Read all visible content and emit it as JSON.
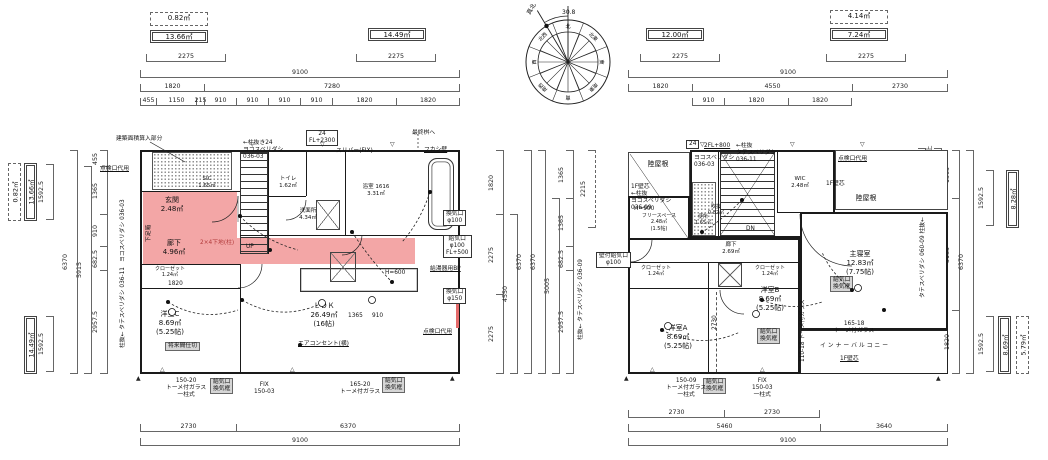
{
  "sheet": {
    "bg": "#ffffff",
    "line": "#1a1a1a",
    "dim": "#666666",
    "pink": "#f3a6a6",
    "gray": "#d6d6d6",
    "red": "#b23b3b"
  },
  "top_boxes": {
    "tl_dashed": "0.82㎡",
    "tl_double": "13.66㎡",
    "tm_double": "14.49㎡",
    "tr_double": "12.00㎡",
    "trr_dashed": "4.14㎡",
    "trr_double": "7.24㎡"
  },
  "side_boxes": {
    "left_top_dashed": "0.82㎡",
    "left_top_double": "13.66㎡",
    "left_bottom_double": "14.49㎡",
    "right_top_double": "8.28㎡",
    "right_bottom_double": "8.69㎡",
    "right_bottom_dashed": "5.79㎡"
  },
  "compass": {
    "dirs": [
      "北",
      "北東",
      "東",
      "南東",
      "南",
      "南西",
      "西",
      "北西"
    ],
    "north_label": "真北",
    "north_angle": "30.8"
  },
  "plan1": {
    "dims": {
      "d2275_left": "2275",
      "d2275_mid": "2275",
      "top_total": "9100",
      "row2": [
        "1820",
        "7280"
      ],
      "row3": [
        "455",
        "1150",
        "215",
        "910",
        "910",
        "910",
        "910",
        "1820",
        "1820"
      ],
      "bottom_row": [
        "2730",
        "6370"
      ],
      "bottom_total": "9100",
      "left_inner": [
        "455",
        "1365",
        "910",
        "682.5",
        "2957.5"
      ],
      "left_mid": "5915",
      "left_outer": "6370",
      "right_inner": [
        "1820",
        "2275",
        "2275"
      ],
      "right_mid": "4550",
      "right_outer": "6370",
      "sidebox_dim": "1592.5",
      "inner_1820": "1820",
      "inner_1365": "1365",
      "inner_910": "910"
    },
    "rooms": {
      "genkan": {
        "name": "玄関",
        "area": "2.48㎡"
      },
      "sic": {
        "name": "SIC",
        "area": "1.65㎡"
      },
      "rouka": {
        "name": "廊下",
        "area": "4.96㎡"
      },
      "toilet": {
        "name": "トイレ",
        "area": "1.62㎡"
      },
      "senmen": {
        "name": "洗面所",
        "area": "4.34㎡"
      },
      "bath": {
        "name": "浴室 1616",
        "area": "3.31㎡"
      },
      "ldk": {
        "name": "ＬＤＫ",
        "area": "26.49㎡",
        "tatami": "(16帖)"
      },
      "yoshitsu_c": {
        "name": "洋室C",
        "area": "8.69㎡",
        "tatami": "(5.25帖)"
      },
      "closet": {
        "name": "クローゼット",
        "area": "1.24㎡"
      },
      "shoebox": "下足箱",
      "up": "UP"
    },
    "notes": {
      "kenchiku": "建築面積算入部分",
      "tenken_top": "点検口代用",
      "win24": "24\nFL+2300",
      "hashira24": "←柱抜き24\nヨコスベリダシ\n036-03",
      "slit": "スリバー(FIX)",
      "masu": "最終桝へ",
      "fukashi": "フカシ壁",
      "kanki100": "換気口\nφ100",
      "kyuki100": "給気口\nφ100\nFL+500",
      "kyutoki": "給湯器用BP",
      "kanki150": "換気口\nφ150",
      "tenken_right": "点検口代用",
      "aircon": "エアコンセント(横)",
      "shitaji": "2×4下地(柱)",
      "majikiri": "将来間仕切",
      "w15020": "150-20\nトーメ付ガラス\n一柱式",
      "kyukikamachi": "給気口\n換気框",
      "fix15003": "FIX\n150-03",
      "w16520": "165-20\nトーメ付ガラス",
      "h600": "H=600",
      "win_left_top": "ヨコスベリダシ 036-03",
      "win_left_bottom": "柱抜← タテスベリダシ 036-11"
    }
  },
  "plan2": {
    "dims": {
      "d2275_left": "2275",
      "d2275_right": "2275",
      "top_total": "9100",
      "row2": [
        "1820",
        "4550",
        "2730"
      ],
      "row3": [
        "910",
        "1820",
        "1820"
      ],
      "bottom_row1": [
        "2730",
        "2730"
      ],
      "bottom_row2": [
        "5460",
        "3640"
      ],
      "bottom_total": "9100",
      "left_inner": [
        "1365",
        "1365",
        "682.5",
        "2957.5"
      ],
      "left_mid": "5005",
      "left_outer": "6370",
      "left_dashed": "2215",
      "right_inner": [
        "1365",
        "3185",
        "1820"
      ],
      "right_outer": "6370",
      "right_dash1": "830",
      "right_dash2": "1000mm以上",
      "sidebox_dim": "1592.5",
      "inner_2730": "2730"
    },
    "rooms": {
      "roof_left": "陸屋根",
      "roof_right": "陸屋根",
      "wic": {
        "name": "WIC",
        "area": "2.48㎡"
      },
      "fukinuke": {
        "name": "吹抜",
        "area": "0.82㎡"
      },
      "benjo": {
        "name": "便所",
        "area": "1.65㎡"
      },
      "free": {
        "name": "フリースペース",
        "area": "2.48㎡",
        "tatami": "(1.5帖)"
      },
      "rouka": {
        "name": "廊下",
        "area": "2.69㎡"
      },
      "shushin": {
        "name": "主寝室",
        "area": "12.83㎡",
        "tatami": "(7.75帖)"
      },
      "yoshitsu_a": {
        "name": "洋室A",
        "area": "8.69㎡",
        "tatami": "(5.25帖)"
      },
      "yoshitsu_b": {
        "name": "洋室B",
        "area": "8.69㎡",
        "tatami": "(5.25帖)"
      },
      "closet": {
        "name": "クローゼット",
        "area": "1.24㎡"
      },
      "balcony": "インナーバルコニー",
      "dn": "DN"
    },
    "notes": {
      "fl800": "2FL+800",
      "win24": "24",
      "yoko0603": "ヨコスベリダシ\n036-03",
      "hashira0611": "←柱抜\nタテスベリダシ\n036-11",
      "left_head": "1F壁芯\n←柱抜\nヨコスベリダシ\n036-09",
      "kabeshin": "1F壁芯",
      "tenken": "点検口代用",
      "h900": "H=900",
      "kabekyuki": "壁付給気口\nφ100",
      "kyukikamachi": "給気口\n換気框",
      "w15009": "150-09\nトーメ付ガラス\n一柱式",
      "fix15003": "FIX\n150-03\n一柱式",
      "w11018": "110-18 トーメ付ガラス",
      "w16518": "165-18\nトーメ付ガラス",
      "w06009": "タテスベリダシ 060-09 柱抜←",
      "win_left_v": "柱抜← タテスベリダシ 036-09"
    }
  }
}
